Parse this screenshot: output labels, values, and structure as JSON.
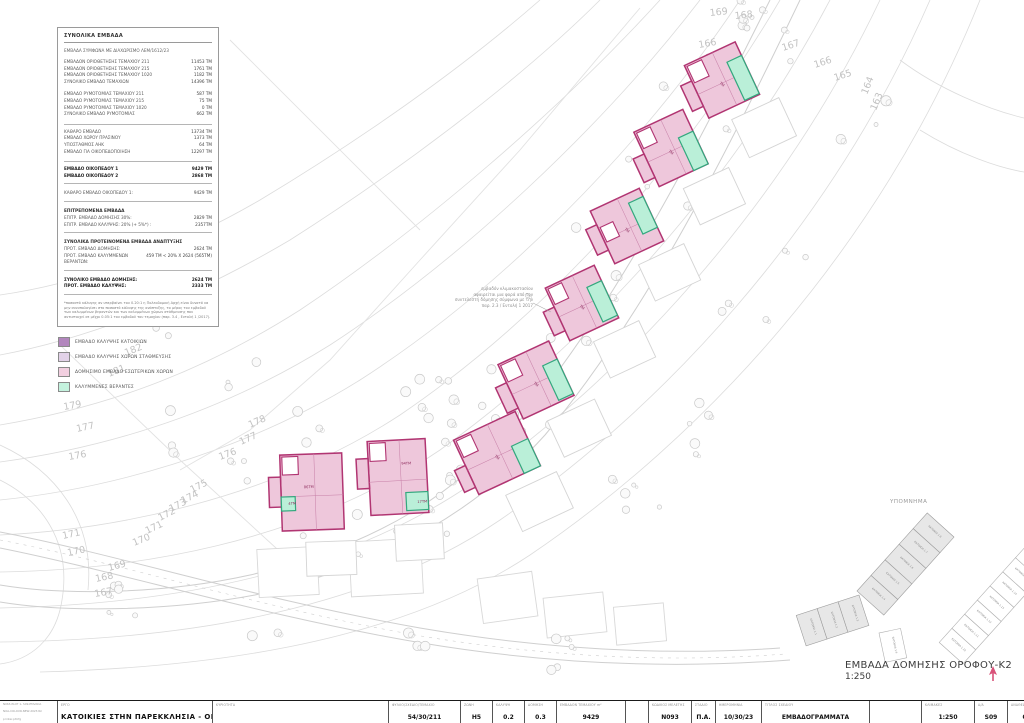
{
  "summary_table": {
    "title": "ΣΥΝΟΛΙΚΑ ΕΜΒΑΔΑ",
    "subtitle": "ΕΜΒΑΔΑ ΣΥΜΦΩΝΑ ΜΕ ΔΙΑΧΩΡΙΣΜΟ ΛΕΜ/1612/23",
    "sections": [
      {
        "rows": [
          [
            "ΕΜΒΑΔΟΝ ΟΡΙΟΘΕΤΗΣΗΣ ΤΕΜΑΧΙΟΥ 211",
            "11453 ΤΜ"
          ],
          [
            "ΕΜΒΑΔΟΝ ΟΡΙΟΘΕΤΗΣΗΣ ΤΕΜΑΧΙΟΥ 215",
            "1761 ΤΜ"
          ],
          [
            "ΕΜΒΑΔΟΝ ΟΡΙΟΘΕΤΗΣΗΣ ΤΕΜΑΧΙΟΥ 1020",
            "1182 ΤΜ"
          ],
          [
            "ΣΥΝΟΛΙΚΟ ΕΜΒΑΔΟ ΤΕΜΑΧΙΩΝ",
            "14396 ΤΜ"
          ]
        ]
      },
      {
        "rows": [
          [
            "ΕΜΒΑΔΟ ΡΥΜΟΤΟΜΙΑΣ ΤΕΜΑΧΙΟΥ 211",
            "587 ΤΜ"
          ],
          [
            "ΕΜΒΑΔΟ ΡΥΜΟΤΟΜΙΑΣ ΤΕΜΑΧΙΟΥ 215",
            "75 ΤΜ"
          ],
          [
            "ΕΜΒΑΔΟ ΡΥΜΟΤΟΜΙΑΣ ΤΕΜΑΧΙΟΥ 1020",
            "0 ΤΜ"
          ],
          [
            "ΣΥΝΟΛΙΚΟ ΕΜΒΑΔΟ ΡΥΜΟΤΟΜΙΑΣ",
            "662 ΤΜ"
          ]
        ]
      },
      {
        "rule_top": true,
        "rows": [
          [
            "ΚΑΘΑΡΟ ΕΜΒΑΔΟ",
            "13734 ΤΜ"
          ],
          [
            "ΕΜΒΑΔΟ ΧΩΡΟΥ ΠΡΑΣΙΝΟΥ",
            "1373 ΤΜ"
          ],
          [
            "ΥΠΟΣΤΑΘΜΟΣ ΑΗΚ",
            "64 ΤΜ"
          ],
          [
            "ΕΜΒΑΔΟ ΓΙΑ ΟΙΚΟΠΕΔΟΠΟΙΗΣΗ",
            "12297 ΤΜ"
          ]
        ]
      },
      {
        "bold": true,
        "rule_top": true,
        "rule_bottom": true,
        "rows": [
          [
            "ΕΜΒΑΔΟ ΟΙΚΟΠΕΔΟΥ 1",
            "9429 ΤΜ"
          ],
          [
            "ΕΜΒΑΔΟ ΟΙΚΟΠΕΔΟΥ 2",
            "2868 ΤΜ"
          ]
        ]
      },
      {
        "rule_bottom": true,
        "rows": [
          [
            "ΚΑΘΑΡΟ ΕΜΒΑΔΟ ΟΙΚΟΠΕΔΟΥ 1:",
            "9429 ΤΜ"
          ]
        ]
      },
      {
        "heading": "ΕΠΙΤΡΕΠΟΜΕΝΑ ΕΜΒΑΔΑ",
        "rule_bottom": true,
        "rows": [
          [
            "ΕΠΙΤΡ. ΕΜΒΑΔΟ ΔΟΜΗΣΗΣ 30%:",
            "2829 ΤΜ"
          ],
          [
            "ΕΠΙΤΡ. ΕΜΒΑΔΟ ΚΑΛΥΨΗΣ: 20% (+ 5%*) :",
            "2357ΤΜ"
          ]
        ]
      },
      {
        "heading": "ΣΥΝΟΛΙΚΑ ΠΡΟΤΕΙΝΟΜΕΝΑ ΕΜΒΑΔΑ ΑΝΑΠΤΥΞΗΣ",
        "rule_bottom": true,
        "rows": [
          [
            "ΠΡΟΤ. ΕΜΒΑΔΟ ΔΟΜΗΣΗΣ:",
            "2624 ΤΜ"
          ],
          [
            "ΠΡΟΤ. ΕΜΒΑΔΟ ΚΑΛΥΜΜΕΝΩΝ ΒΕΡΑΝΤΩΝ:",
            "459 ΤΜ < 20% Χ 2624 (565ΤΜ)"
          ]
        ]
      },
      {
        "bold": true,
        "rule_bottom": true,
        "rows": [
          [
            "ΣΥΝΟΛΙΚΟ ΕΜΒΑΔΟ ΔΟΜΗΣΗΣ:",
            "2624 ΤΜ"
          ],
          [
            "ΠΡΟΤ. ΕΜΒΑΔΟ ΚΑΛΥΨΗΣ:",
            "2333 ΤΜ"
          ]
        ]
      }
    ],
    "footnote": "*ποσοστό κάλυψης αν υπερβαίνει του 0.20:1 η Πολεοδομική Αρχή είναι δυνατό να μην συνυπολογίσει στο ποσοστό κάλυψης της ανάπτυξης, το μέρος του εμβαδού των καλυμμένων βεραντών και των καλυμμένων χώρων στάθμευσης που αντιστοιχεί σε μέχρι 0.05:1 του εμβαδού του τεμαχίου (παρ. 3.4 , Εντολή 1 /2017)."
  },
  "legend": {
    "items": [
      {
        "label": "ΕΜΒΑΔΟ ΚΑΛΥΨΗΣ ΚΑΤΟΙΚΙΩΝ",
        "color": "#b286bd"
      },
      {
        "label": "ΕΜΒΑΔΟ ΚΑΛΥΨΗΣ ΧΩΡΩΝ ΣΤΑΘΜΕΥΣΗΣ",
        "color": "#e2d2e8"
      },
      {
        "label": "ΔΟΜΗΣΙΜΟ ΕΜΒΑΔΟ ΕΣΩΤΕΡΙΚΩΝ ΧΩΡΩΝ",
        "color": "#f2cfe0"
      },
      {
        "label": "ΚΑΛΥΜΜΕΝΕΣ ΒΕΡΑΝΤΕΣ",
        "color": "#c4f2de"
      }
    ]
  },
  "plan": {
    "annotation": {
      "lines": [
        "εμβαδόν κλιμακοστασίου",
        "αφαιρείται μια φορά από τον",
        "συντελεστή δόμησης σύμφωνα με την",
        "παρ. 2.3 / Εντολή 1 2017"
      ]
    },
    "colors": {
      "building_fill": "#eec7db",
      "building_stroke": "#b13572",
      "veranda_fill": "#baefd8",
      "veranda_stroke": "#33a87e",
      "contour": "#dcdcdc",
      "contour_label": "#c2c2c2"
    },
    "contour_labels": [
      {
        "t": "169",
        "x": 710,
        "y": 16,
        "r": -6
      },
      {
        "t": "168",
        "x": 735,
        "y": 19,
        "r": -6
      },
      {
        "t": "167",
        "x": 783,
        "y": 51,
        "r": -18
      },
      {
        "t": "166",
        "x": 815,
        "y": 68,
        "r": -18
      },
      {
        "t": "165",
        "x": 835,
        "y": 81,
        "r": -18
      },
      {
        "t": "166",
        "x": 699,
        "y": 48,
        "r": -10
      },
      {
        "t": "165",
        "x": 706,
        "y": 61,
        "r": -10
      },
      {
        "t": "164",
        "x": 867,
        "y": 95,
        "r": -68
      },
      {
        "t": "163",
        "x": 876,
        "y": 111,
        "r": -68
      },
      {
        "t": "183",
        "x": 138,
        "y": 325,
        "r": -18
      },
      {
        "t": "182",
        "x": 126,
        "y": 356,
        "r": -22
      },
      {
        "t": "181",
        "x": 109,
        "y": 377,
        "r": -22
      },
      {
        "t": "179",
        "x": 64,
        "y": 410,
        "r": -10
      },
      {
        "t": "177",
        "x": 77,
        "y": 432,
        "r": -12
      },
      {
        "t": "176",
        "x": 69,
        "y": 460,
        "r": -10
      },
      {
        "t": "178",
        "x": 250,
        "y": 428,
        "r": -24
      },
      {
        "t": "177",
        "x": 241,
        "y": 445,
        "r": -24
      },
      {
        "t": "176",
        "x": 220,
        "y": 460,
        "r": -20
      },
      {
        "t": "175",
        "x": 192,
        "y": 493,
        "r": -27
      },
      {
        "t": "174",
        "x": 183,
        "y": 504,
        "r": -27
      },
      {
        "t": "173",
        "x": 171,
        "y": 512,
        "r": -27
      },
      {
        "t": "172",
        "x": 160,
        "y": 521,
        "r": -27
      },
      {
        "t": "171",
        "x": 147,
        "y": 534,
        "r": -25
      },
      {
        "t": "170",
        "x": 134,
        "y": 546,
        "r": -22
      },
      {
        "t": "169",
        "x": 109,
        "y": 571,
        "r": -15
      },
      {
        "t": "168",
        "x": 96,
        "y": 582,
        "r": -12
      },
      {
        "t": "171",
        "x": 63,
        "y": 539,
        "r": -12
      },
      {
        "t": "170",
        "x": 68,
        "y": 556,
        "r": -12
      },
      {
        "t": "167",
        "x": 95,
        "y": 597,
        "r": -10
      }
    ],
    "buildings": [
      {
        "cx": 722,
        "cy": 80,
        "rot": -25,
        "body": [
          -28,
          -29,
          56,
          58
        ],
        "wing": [
          -40,
          -12,
          12,
          28
        ],
        "notch": [
          -26,
          -27,
          16,
          18
        ],
        "teal": [
          12,
          -14,
          16,
          42
        ],
        "ghost": [
          -8,
          40,
          52,
          42
        ],
        "labels": [
          {
            "t": "ΤΜ",
            "x": -4,
            "y": 2,
            "r": 65
          }
        ]
      },
      {
        "cx": 671,
        "cy": 148,
        "rot": -25,
        "body": [
          -27,
          -30,
          54,
          60
        ],
        "wing": [
          -39,
          -6,
          12,
          26
        ],
        "notch": [
          -25,
          -28,
          15,
          17
        ],
        "teal": [
          11,
          -6,
          16,
          36
        ],
        "ghost": [
          -6,
          42,
          50,
          40
        ],
        "labels": [
          {
            "t": "ΤΜ",
            "x": -4,
            "y": 2,
            "r": 65
          }
        ]
      },
      {
        "cx": 627,
        "cy": 226,
        "rot": -25,
        "body": [
          -27,
          -29,
          54,
          58
        ],
        "wing": [
          -39,
          -14,
          12,
          28
        ],
        "notch": [
          -25,
          -10,
          14,
          16
        ],
        "teal": [
          11,
          -20,
          16,
          34
        ],
        "ghost": [
          -6,
          40,
          50,
          40
        ],
        "labels": [
          {
            "t": "ΤΜ",
            "x": -4,
            "y": 2,
            "r": 65
          }
        ]
      },
      {
        "cx": 582,
        "cy": 303,
        "rot": -25,
        "body": [
          -27,
          -29,
          54,
          58
        ],
        "wing": [
          -39,
          -8,
          12,
          26
        ],
        "notch": [
          -25,
          -27,
          15,
          17
        ],
        "teal": [
          11,
          -12,
          16,
          38
        ],
        "ghost": [
          -6,
          40,
          50,
          40
        ],
        "labels": [
          {
            "t": "ΤΜ",
            "x": -4,
            "y": 2,
            "r": 65
          }
        ]
      },
      {
        "cx": 536,
        "cy": 380,
        "rot": -25,
        "body": [
          -28,
          -30,
          56,
          60
        ],
        "wing": [
          -40,
          -10,
          12,
          28
        ],
        "notch": [
          -26,
          -28,
          16,
          18
        ],
        "teal": [
          12,
          -10,
          16,
          38
        ],
        "ghost": [
          -7,
          42,
          52,
          40
        ],
        "labels": [
          {
            "t": "ΤΜ",
            "x": -4,
            "y": 2,
            "r": 65
          }
        ]
      },
      {
        "cx": 497,
        "cy": 453,
        "rot": -25,
        "body": [
          -34,
          -30,
          68,
          60
        ],
        "wing": [
          -46,
          -2,
          12,
          24
        ],
        "notch": [
          -32,
          -28,
          16,
          18
        ],
        "teal": [
          16,
          0,
          18,
          30
        ],
        "ghost": [
          -10,
          42,
          56,
          40
        ],
        "labels": [
          {
            "t": "ΤΜ",
            "x": -4,
            "y": 2,
            "r": 65
          }
        ]
      },
      {
        "cx": 398,
        "cy": 477,
        "rot": -3,
        "body": [
          -29,
          -37,
          58,
          74
        ],
        "wing": [
          -41,
          -20,
          12,
          30
        ],
        "notch": [
          -27,
          -35,
          16,
          18
        ],
        "teal": [
          7,
          16,
          22,
          18
        ],
        "ghost": [
          -6,
          48,
          48,
          36
        ],
        "labels": [
          {
            "t": "94ΤΜ",
            "x": 4,
            "y": -12,
            "r": 0
          },
          {
            "t": "17ΤΜ",
            "x": 18,
            "y": 27,
            "r": 0
          }
        ]
      },
      {
        "cx": 312,
        "cy": 492,
        "rot": -2,
        "body": [
          -31,
          -38,
          62,
          76
        ],
        "wing": [
          -43,
          -16,
          12,
          30
        ],
        "notch": [
          -29,
          -36,
          16,
          18
        ],
        "teal": [
          -31,
          4,
          14,
          14
        ],
        "ghost": [
          -8,
          50,
          50,
          34
        ],
        "labels": [
          {
            "t": "86ΤΜ",
            "x": -8,
            "y": -4,
            "r": 0
          },
          {
            "t": "4ΤΜ",
            "x": -24,
            "y": 12,
            "r": 0
          }
        ]
      }
    ],
    "keymap": {
      "title": "ΥΠΟΜΝΗΜΑ",
      "selected_plots": [
        "ΚΑΤΟΙΚΙΑ 1.1",
        "ΚΑΤΟΙΚΙΑ 1.2",
        "ΚΑΤΟΙΚΙΑ 1.3",
        "ΚΑΤΟΙΚΙΑ 1.4",
        "ΚΑΤΟΙΚΙΑ 1.5",
        "ΚΑΤΟΙΚΙΑ 1.6",
        "ΚΑΤΟΙΚΙΑ 1.7",
        "ΚΑΤΟΙΚΙΑ 1.8"
      ],
      "other_plots": [
        "ΚΑΤΟΙΚΙΑ 1.9",
        "ΚΑΤΟΙΚΙΑ 1.10",
        "ΚΑΤΟΙΚΙΑ 1.11",
        "ΚΑΤΟΙΚΙΑ 1.12",
        "ΚΑΤΟΙΚΙΑ 1.13",
        "ΚΑΤΟΙΚΙΑ 1.14",
        "ΚΑΤΟΙΚΙΑ 1.15",
        "ΚΑΤΟΙΚΙΑ 1.16"
      ]
    }
  },
  "plan_title": {
    "text": "ΕΜΒΑΔΑ ΔΟΜΗΣΗΣ ΟΡΟΦΟΥ-Κ2",
    "scale": "1:250"
  },
  "titleblock": {
    "print_info": [
      "N063-PLOT 1- S09-EMVADA",
      "NOA-COLOUR-NEW-2023.tbl",
      "printer.pltcfg"
    ],
    "project_label": "ΕΡΓΟ",
    "project": "ΚΑΤΟΙΚΙΕΣ ΣΤΗΝ ΠΑΡΕΚΚΛΗΣΙΑ - ΟΙΚΟΠΕΔΟ 1",
    "ownership_label": "ΚΥΡΙΟΤΗΤΑ",
    "fields": [
      {
        "label": "ΦΥΛΛΟ/ΣΧΕΔΙΟ/ΤΕΜΑΧΙΟ",
        "value": "54/30/211"
      },
      {
        "label": "ΖΩΝΗ",
        "value": "Η5"
      },
      {
        "label": "ΚΑΛΥΨΗ",
        "value": "0.2"
      },
      {
        "label": "ΔΟΜΗΣΗ",
        "value": "0.3"
      },
      {
        "label": "ΕΜΒΑΔΟΝ ΤΕΜΑΧΙΟΥ m²",
        "value": "9429"
      },
      {
        "label": "ΚΩΔΙΚΟΣ ΜΕΛΕΤΗΣ",
        "value": "Ν093"
      },
      {
        "label": "ΣΤΑΔΙΟ",
        "value": "Π.Α."
      },
      {
        "label": "ΗΜΕΡΟΜΗΝΙΑ",
        "value": "10/30/23"
      },
      {
        "label": "ΤΙΤΛΟΣ ΣΧΕΔΙΟΥ",
        "value": "ΕΜΒΑΔΟΓΡΑΜΜΑΤΑ"
      },
      {
        "label": "ΚΛΙΜΑΚΕΣ",
        "value": "1:250"
      },
      {
        "label": "Α/Α",
        "value": "S09"
      },
      {
        "label": "ΑΝΑΘΕΩΡΗΣΗ",
        "value": "00-000000"
      }
    ]
  }
}
